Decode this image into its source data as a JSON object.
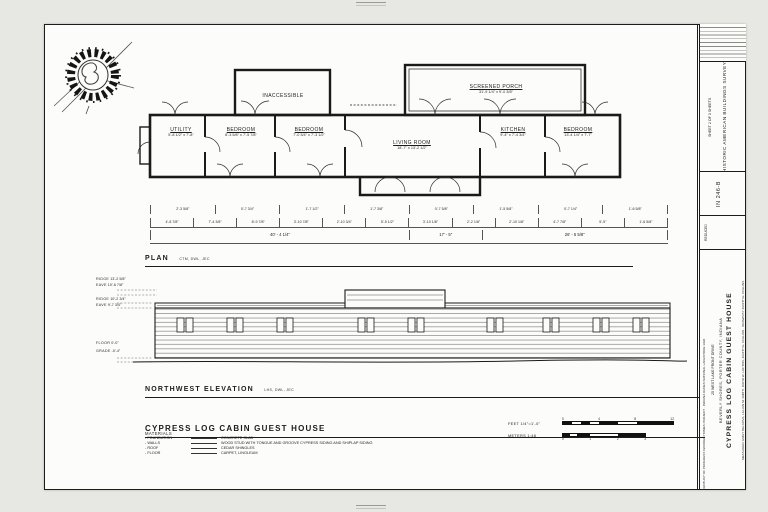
{
  "plan": {
    "label": "PLAN",
    "label_note": "CTM, DWL, JEC",
    "rooms": [
      {
        "name": "UTILITY",
        "dims": "5'-8 1/2\" x 7'-8\""
      },
      {
        "name": "BEDROOM",
        "dims": "8'-3 5/8\" x 7'-5 7/8\""
      },
      {
        "name": "BEDROOM",
        "dims": "7'-0 3/4\" x 7'-3 1/2\""
      },
      {
        "name": "LIVING ROOM",
        "dims": "18'-7\" x 13'-2 1/2\""
      },
      {
        "name": "KITCHEN",
        "dims": "9'-4\" x 7'-4 3/4\""
      },
      {
        "name": "BEDROOM",
        "dims": "13'-4 1/4\" x 7'-7\""
      },
      {
        "name": "SCREENED PORCH",
        "dims": "31'-9 1/4\" x 9'-0 3/8\""
      },
      {
        "name": "INACCESSIBLE",
        "dims": ""
      }
    ],
    "dim_row_upper": [
      "2'-3 5/8\"",
      "0'-7 3/4\"",
      "1'-7 1/2\"",
      "1'-7 3/8\"",
      "0'-7 5/8\"",
      "1'-5 5/8\"",
      "0'-7 1/4\"",
      "1'-6 5/8\""
    ],
    "dim_row_lower": [
      "4'-8 7/8\"",
      "7'-4 3/8\"",
      "8'-9 7/8\"",
      "3'-10 7/8\"",
      "2'-10 3/4\"",
      "5'-5 1/2\"",
      "3'-10 1/8\"",
      "2'-2 1/8\"",
      "2'-10 1/8\"",
      "4'-7 7/8\"",
      "5'-5\"",
      "1'-6 5/8\""
    ],
    "dim_totals": [
      "40' - 4 1/4\"",
      "17' - 5\"",
      "26' - 5 5/8\""
    ]
  },
  "elevation": {
    "label": "NORTHWEST ELEVATION",
    "label_note": "LHS, DWL, JEC",
    "levels": [
      {
        "name": "RIDGE",
        "value": "13'-2 5/8\""
      },
      {
        "name": "EAVE",
        "value": "10'-6 7/8\""
      },
      {
        "name": "RIDGE",
        "value": "10'-2 3/4\""
      },
      {
        "name": "EAVE",
        "value": "9'-7 3/4\""
      },
      {
        "name": "FLOOR",
        "value": "0'-0\""
      },
      {
        "name": "GRADE",
        "value": "-0'-4\""
      }
    ]
  },
  "footer": {
    "title": "CYPRESS LOG CABIN GUEST HOUSE",
    "materials_heading": "MATERIALS",
    "materials": [
      {
        "name": "- FOUNDATION",
        "value": "CONCRETE SLAB"
      },
      {
        "name": "- WALLS",
        "value": "WOOD STUD WITH TONGUE AND GROOVE CYPRESS SIDING AND SHIPLAP SIDING"
      },
      {
        "name": "- ROOF",
        "value": "CEDAR SHINGLES"
      },
      {
        "name": "- FLOOR",
        "value": "CARPET, LINOLEUM"
      }
    ],
    "scale": {
      "feet_label": "FEET  1/4\"=1'-0\"",
      "meters_label": "METERS  1:48",
      "feet_tick_0": "0",
      "feet_tick_1": "4",
      "feet_tick_2": "8",
      "feet_tick_3": "12",
      "meters_tick_0": "0",
      "meters_tick_1": "1",
      "meters_tick_2": "2",
      "meters_tick_3": "3"
    }
  },
  "titleblock": {
    "agency": "HISTORIC AMERICAN BUILDINGS SURVEY",
    "sheet_line": "SHEET 2 OF 3 SHEETS",
    "survey_no": "IN 246-B",
    "reduced": "REDUCED",
    "credit_measured": "MEASURED: EMILY BELKOVA, LILLIAN M. SMITH, DAVID W. LOFTON, JUDITH E. COLLINS · DRAWN BY JUDITH E. COLLINS",
    "main_title": "CYPRESS LOG CABIN GUEST HOUSE",
    "subtitle": "BEVERLY SHORES, PORTER COUNTY, INDIANA",
    "address": "25 WEST LAKE FRONT DRIVE",
    "project": "CENTURY OF PROGRESS WOODED HOMES PROJECT · INDIANA DUNES NATIONAL LAKESHORE 1994"
  }
}
